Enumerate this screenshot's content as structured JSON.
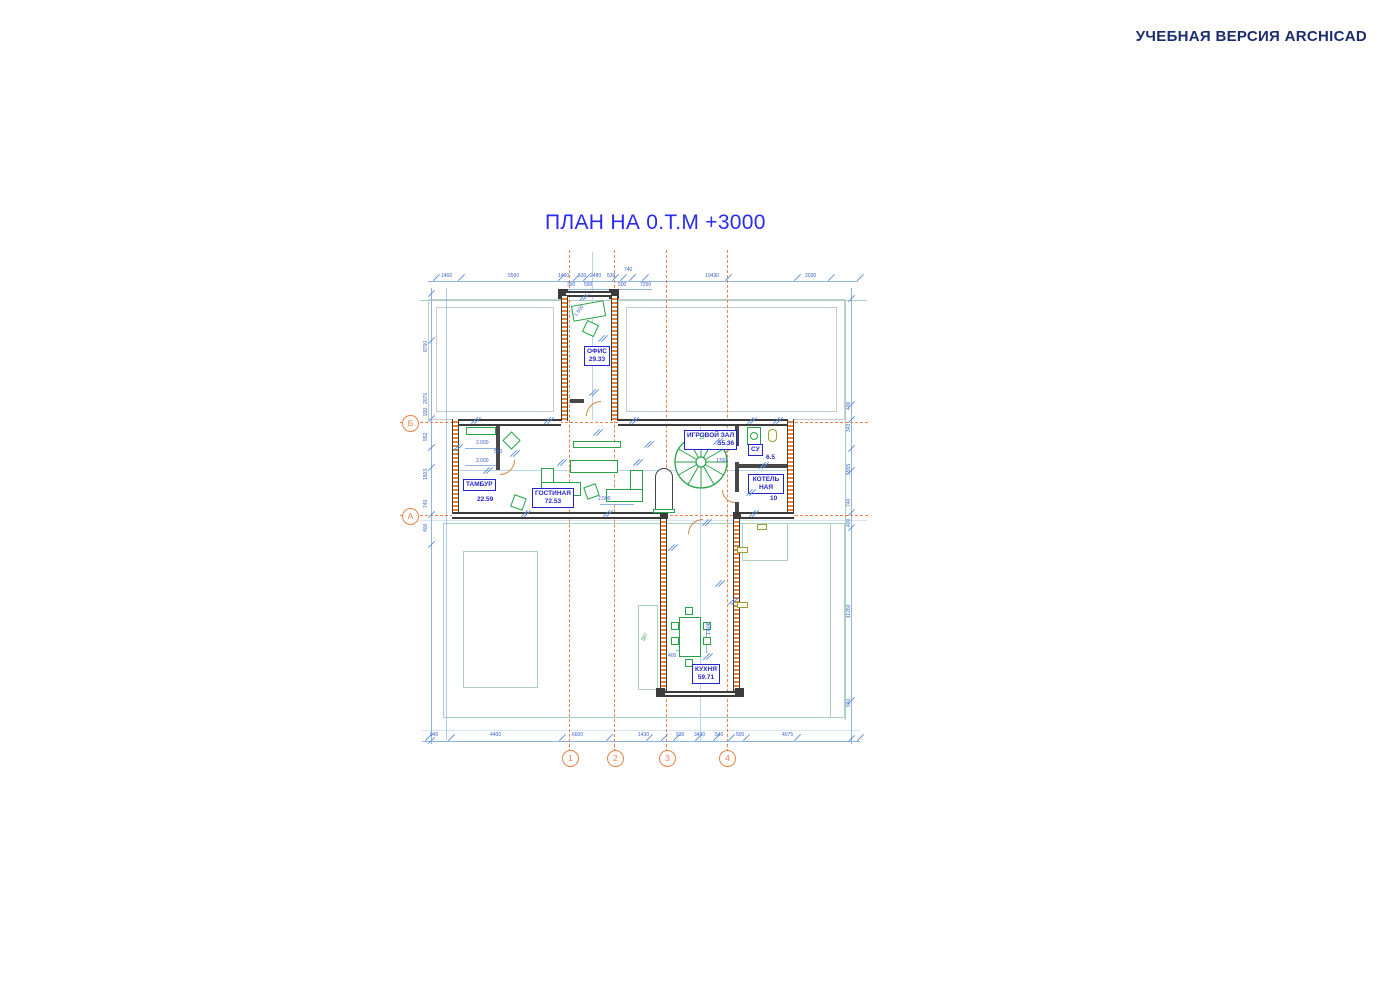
{
  "watermark": "УЧЕБНАЯ ВЕРСИЯ ARCHICAD",
  "title": "ПЛАН НА 0.Т.М +3000",
  "axes": {
    "rows": [
      "Б",
      "А"
    ],
    "cols": [
      "1",
      "2",
      "3",
      "4"
    ]
  },
  "rooms": [
    {
      "name": "ОФИС",
      "area": "29.33"
    },
    {
      "name": "ТАМБУР",
      "area": "22.59"
    },
    {
      "name": "ГОСТИНАЯ",
      "area": "72.53"
    },
    {
      "name": "ИГРОВОЙ ЗАЛ",
      "area": "55.36"
    },
    {
      "name": "СУ",
      "area": "6.5"
    },
    {
      "name": "КОТЕЛЬНАЯ",
      "area": "10"
    },
    {
      "name": "КУХНЯ",
      "area": "59.71"
    }
  ],
  "colors": {
    "title": "#2a2af2",
    "watermark": "#1b2d6e",
    "axis": "#e8824a",
    "dimension": "#8fb4e2",
    "dimension_text": "#3a5fc8",
    "wall": "#3b3b3b",
    "wall_hatch": "#e8833a",
    "furniture": "#27a347",
    "fixture": "#9aa038",
    "room_label": "#2424cc"
  },
  "annotations": [
    {
      "t": "1460",
      "x": 441,
      "y": 274
    },
    {
      "t": "5500",
      "x": 508,
      "y": 274
    },
    {
      "t": "1460",
      "x": 558,
      "y": 274
    },
    {
      "t": "530",
      "x": 578,
      "y": 274
    },
    {
      "t": "2480",
      "x": 590,
      "y": 274
    },
    {
      "t": "530",
      "x": 607,
      "y": 274
    },
    {
      "t": "740",
      "x": 624,
      "y": 268
    },
    {
      "t": "10430",
      "x": 705,
      "y": 274
    },
    {
      "t": "2030",
      "x": 805,
      "y": 274
    },
    {
      "t": "390",
      "x": 567,
      "y": 283
    },
    {
      "t": "590",
      "x": 584,
      "y": 283
    },
    {
      "t": "500",
      "x": 618,
      "y": 283
    },
    {
      "t": "7250",
      "x": 640,
      "y": 283
    },
    {
      "t": "940",
      "x": 430,
      "y": 733
    },
    {
      "t": "4400",
      "x": 490,
      "y": 733
    },
    {
      "t": "6600",
      "x": 572,
      "y": 733
    },
    {
      "t": "1430",
      "x": 638,
      "y": 733
    },
    {
      "t": "530",
      "x": 676,
      "y": 733
    },
    {
      "t": "3430",
      "x": 694,
      "y": 733
    },
    {
      "t": "540",
      "x": 715,
      "y": 733
    },
    {
      "t": "500",
      "x": 736,
      "y": 733
    },
    {
      "t": "4075",
      "x": 782,
      "y": 733
    },
    {
      "t": "8750",
      "x": 424,
      "y": 352,
      "r": -90
    },
    {
      "t": "2075",
      "x": 424,
      "y": 404,
      "r": -90
    },
    {
      "t": "930",
      "x": 424,
      "y": 416,
      "r": -90
    },
    {
      "t": "552",
      "x": 424,
      "y": 441,
      "r": -90
    },
    {
      "t": "1503",
      "x": 424,
      "y": 480,
      "r": -90
    },
    {
      "t": "740",
      "x": 424,
      "y": 508,
      "r": -90
    },
    {
      "t": "400",
      "x": 424,
      "y": 532,
      "r": -90
    },
    {
      "t": "400",
      "x": 847,
      "y": 410,
      "r": -90
    },
    {
      "t": "343",
      "x": 847,
      "y": 432,
      "r": -90
    },
    {
      "t": "5555",
      "x": 847,
      "y": 475,
      "r": -90
    },
    {
      "t": "740",
      "x": 847,
      "y": 507,
      "r": -90
    },
    {
      "t": "400",
      "x": 847,
      "y": 527,
      "r": -90
    },
    {
      "t": "11260",
      "x": 847,
      "y": 618,
      "r": -90
    },
    {
      "t": "960",
      "x": 847,
      "y": 707,
      "r": -90
    },
    {
      "t": "2.000",
      "x": 476,
      "y": 441
    },
    {
      "t": "2.000",
      "x": 476,
      "y": 459
    },
    {
      "t": "500",
      "x": 494,
      "y": 450
    },
    {
      "t": "1700",
      "x": 716,
      "y": 459
    },
    {
      "t": "2.500",
      "x": 598,
      "y": 497
    },
    {
      "t": "1.606",
      "x": 707,
      "y": 635,
      "r": -90
    },
    {
      "t": "400",
      "x": 668,
      "y": 654
    },
    {
      "t": "1.500",
      "x": 574,
      "y": 315,
      "r": -55
    },
    {
      "t": "15",
      "x": 699,
      "y": 436,
      "c": "g"
    },
    {
      "t": "387",
      "x": 641,
      "y": 640,
      "r": -60,
      "c": "g"
    }
  ]
}
